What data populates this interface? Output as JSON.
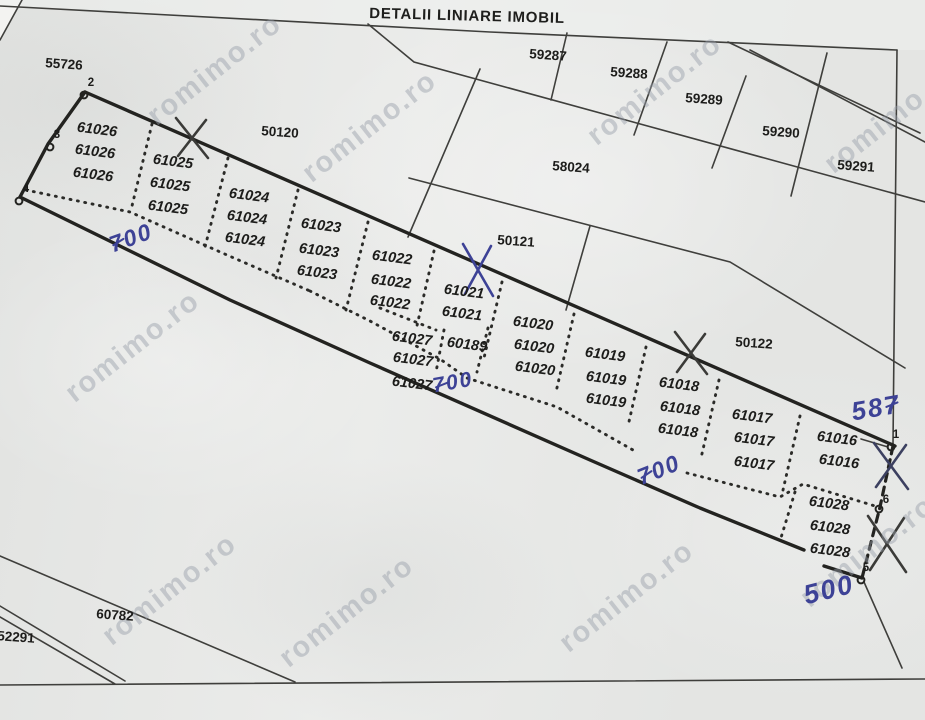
{
  "title": "DETALII LINIARE IMOBIL",
  "watermark_text": "romimo.ro",
  "watermarks": [
    {
      "x": 215,
      "y": 70
    },
    {
      "x": 370,
      "y": 127
    },
    {
      "x": 655,
      "y": 90
    },
    {
      "x": 892,
      "y": 118
    },
    {
      "x": 133,
      "y": 347
    },
    {
      "x": 170,
      "y": 590
    },
    {
      "x": 347,
      "y": 612
    },
    {
      "x": 627,
      "y": 597
    },
    {
      "x": 868,
      "y": 552
    }
  ],
  "strip_parcels": [
    {
      "id": "61026",
      "labels": [
        [
          97,
          130
        ],
        [
          95,
          152
        ],
        [
          93,
          175
        ]
      ]
    },
    {
      "id": "61025",
      "labels": [
        [
          173,
          162
        ],
        [
          170,
          185
        ],
        [
          168,
          208
        ]
      ]
    },
    {
      "id": "61024",
      "labels": [
        [
          249,
          196
        ],
        [
          247,
          218
        ],
        [
          245,
          240
        ]
      ]
    },
    {
      "id": "61023",
      "labels": [
        [
          321,
          226
        ],
        [
          319,
          251
        ],
        [
          317,
          273
        ]
      ]
    },
    {
      "id": "61022",
      "labels": [
        [
          392,
          258
        ],
        [
          391,
          282
        ],
        [
          390,
          303
        ]
      ]
    },
    {
      "id": "61021",
      "labels": [
        [
          464,
          292
        ],
        [
          462,
          314
        ]
      ]
    },
    {
      "id": "61020",
      "labels": [
        [
          533,
          324
        ],
        [
          534,
          347
        ],
        [
          535,
          369
        ]
      ]
    },
    {
      "id": "61019",
      "labels": [
        [
          605,
          355
        ],
        [
          606,
          379
        ],
        [
          606,
          401
        ]
      ]
    },
    {
      "id": "61018",
      "labels": [
        [
          679,
          385
        ],
        [
          680,
          409
        ],
        [
          678,
          431
        ]
      ]
    },
    {
      "id": "61017",
      "labels": [
        [
          752,
          417
        ],
        [
          754,
          440
        ],
        [
          754,
          464
        ]
      ]
    },
    {
      "id": "61016",
      "labels": [
        [
          837,
          439
        ],
        [
          839,
          462
        ]
      ]
    },
    {
      "id": "61028",
      "labels": [
        [
          829,
          504
        ],
        [
          830,
          528
        ],
        [
          830,
          551
        ]
      ]
    },
    {
      "id": "61027",
      "labels": [
        [
          412,
          339
        ],
        [
          413,
          360
        ],
        [
          412,
          384
        ]
      ]
    },
    {
      "id": "60189",
      "labels": [
        [
          467,
          345
        ]
      ]
    }
  ],
  "surrounding_parcels": [
    {
      "id": "55726",
      "x": 64,
      "y": 64
    },
    {
      "id": "50120",
      "x": 280,
      "y": 132
    },
    {
      "id": "58024",
      "x": 571,
      "y": 167
    },
    {
      "id": "50121",
      "x": 516,
      "y": 241
    },
    {
      "id": "50122",
      "x": 754,
      "y": 343
    },
    {
      "id": "59287",
      "x": 548,
      "y": 55
    },
    {
      "id": "59288",
      "x": 629,
      "y": 73
    },
    {
      "id": "59289",
      "x": 704,
      "y": 99
    },
    {
      "id": "59290",
      "x": 781,
      "y": 132
    },
    {
      "id": "59291",
      "x": 856,
      "y": 166
    },
    {
      "id": "60782",
      "x": 115,
      "y": 615
    },
    {
      "id": "52291",
      "x": 16,
      "y": 637
    }
  ],
  "boundary_points": [
    {
      "n": "2",
      "cx": 84,
      "cy": 95,
      "lx": 91,
      "ly": 83
    },
    {
      "n": "3",
      "cx": 50,
      "cy": 147,
      "lx": 57,
      "ly": 135
    },
    {
      "n": "4",
      "cx": 19,
      "cy": 201,
      "lx": 26,
      "ly": 189
    },
    {
      "n": "1",
      "cx": 891,
      "cy": 447,
      "lx": 896,
      "ly": 435
    },
    {
      "n": "6",
      "cx": 879,
      "cy": 509,
      "lx": 886,
      "ly": 500
    },
    {
      "n": "5",
      "cx": 861,
      "cy": 580,
      "lx": 866,
      "ly": 568
    }
  ],
  "handwritten": [
    {
      "text": "700",
      "x": 131,
      "y": 238,
      "rot": -20,
      "size": 23,
      "slash_at": 0
    },
    {
      "text": "700",
      "x": 453,
      "y": 383,
      "rot": -10,
      "size": 21,
      "slash_at": 0
    },
    {
      "text": "700",
      "x": 659,
      "y": 470,
      "rot": -22,
      "size": 23,
      "slash_at": 0
    },
    {
      "text": "587",
      "x": 876,
      "y": 408,
      "rot": -10,
      "size": 26,
      "slash_at": 2
    },
    {
      "text": "500",
      "x": 829,
      "y": 590,
      "rot": -14,
      "size": 27,
      "slash_at": null
    }
  ],
  "x_marks": [
    {
      "cx": 192,
      "cy": 138,
      "w": 32,
      "h": 40,
      "ink": "pencil"
    },
    {
      "cx": 478,
      "cy": 270,
      "w": 30,
      "h": 52,
      "ink": "blue"
    },
    {
      "cx": 691,
      "cy": 353,
      "w": 32,
      "h": 42,
      "ink": "pencil"
    },
    {
      "cx": 891,
      "cy": 466,
      "w": 34,
      "h": 46,
      "ink": "darkblue"
    },
    {
      "cx": 887,
      "cy": 544,
      "w": 38,
      "h": 56,
      "ink": "pencil"
    }
  ],
  "colors": {
    "ink_blue": "#3d4296",
    "pencil": "#3b3b38",
    "darkblue": "#3c4060",
    "label": "#1c1c1a"
  }
}
